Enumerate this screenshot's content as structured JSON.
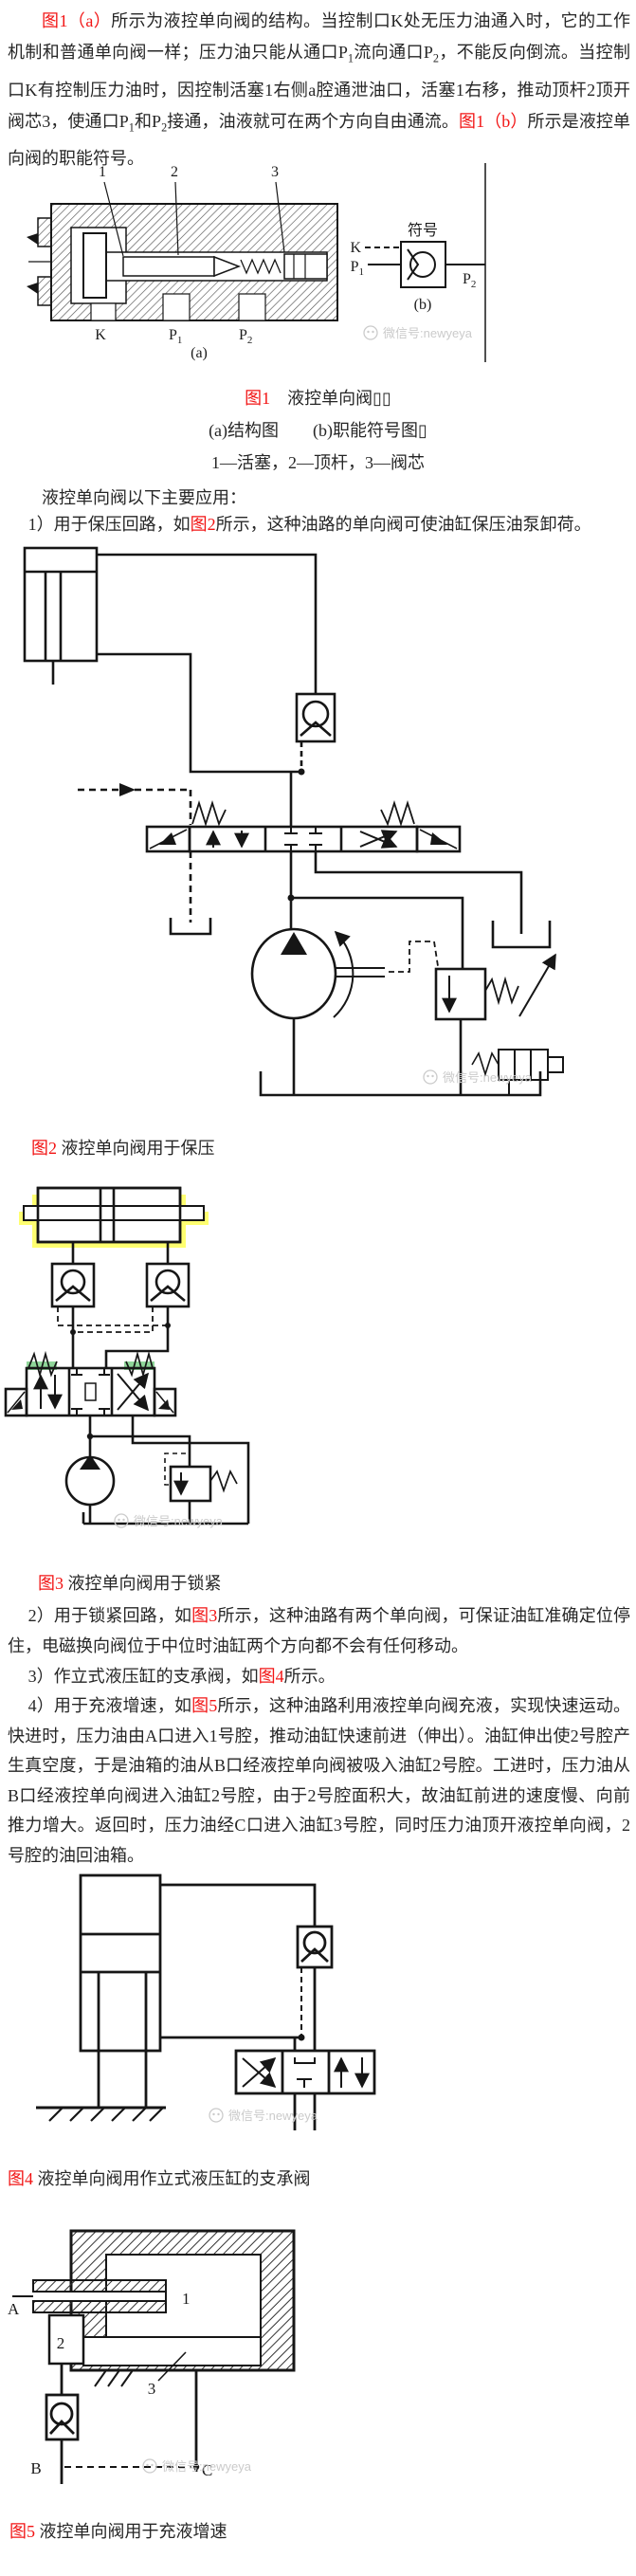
{
  "colors": {
    "red": "#f21414",
    "text": "#262626",
    "watermark": "#cbcbcb",
    "yellow": "#ffff70",
    "green": "#44bb55",
    "line": "#161616"
  },
  "watermark": "微信号:newyeya",
  "intro": {
    "segments": [
      {
        "t": "图1（a）",
        "c": "red"
      },
      {
        "t": "所示为液控单向阀的结构。当控制口K处无压力油通入时，它的工作机制和普通单向阀一样；压力油只能从通口P"
      },
      {
        "t": "1",
        "sub": true
      },
      {
        "t": "流向通口P"
      },
      {
        "t": "2",
        "sub": true
      },
      {
        "t": "，不能反向倒流。当控制口K有控制压力油时，因控制活塞1右侧a腔通泄油口，活塞1右移，推动顶杆2顶开阀芯3，使通口P"
      },
      {
        "t": "1",
        "sub": true
      },
      {
        "t": "和P"
      },
      {
        "t": "2",
        "sub": true
      },
      {
        "t": "接通，油液就可在两个方向自由通流。"
      },
      {
        "t": "图1（b）",
        "c": "red"
      },
      {
        "t": "所示是液控单向阀的职能符号。"
      }
    ]
  },
  "fig1": {
    "labels": {
      "n1": "1",
      "n2": "2",
      "n3": "3",
      "k": "K",
      "p": "P",
      "s1": "1",
      "s2": "2",
      "a": "(a)",
      "sym": "符号",
      "b": "(b)"
    }
  },
  "caption1": {
    "line1": {
      "segments": [
        {
          "t": "图1",
          "c": "red"
        },
        {
          "t": "　液控单向阀▯▯"
        }
      ]
    },
    "line2": {
      "segments": [
        {
          "t": "(a)结构图　　(b)职能符号图▯"
        }
      ]
    },
    "line3": {
      "segments": [
        {
          "t": "1—活塞，2—顶杆，3—阀芯"
        }
      ]
    }
  },
  "apps": {
    "segments": [
      {
        "t": "液控单向阀以下主要应用："
      }
    ]
  },
  "item1": {
    "segments": [
      {
        "t": "1）用于保压回路，如"
      },
      {
        "t": "图2",
        "c": "red"
      },
      {
        "t": "所示，这种油路的单向阀可使油缸保压油泵卸荷。"
      }
    ]
  },
  "caption2": {
    "segments": [
      {
        "t": "图2",
        "c": "red"
      },
      {
        "t": " 液控单向阀用于保压"
      }
    ]
  },
  "caption3": {
    "segments": [
      {
        "t": "图3",
        "c": "red"
      },
      {
        "t": " 液控单向阀用于锁紧"
      }
    ]
  },
  "item2": {
    "segments": [
      {
        "t": "2）用于锁紧回路，如"
      },
      {
        "t": "图3",
        "c": "red"
      },
      {
        "t": "所示，这种油路有两个单向阀，可保证油缸准确定位停住，电磁换向阀位于中位时油缸两个方向都不会有任何移动。"
      }
    ]
  },
  "item3": {
    "segments": [
      {
        "t": "3）作立式液压缸的支承阀，如"
      },
      {
        "t": "图4",
        "c": "red"
      },
      {
        "t": "所示。"
      }
    ]
  },
  "item4": {
    "segments": [
      {
        "t": "4）用于充液增速，如"
      },
      {
        "t": "图5",
        "c": "red"
      },
      {
        "t": "所示，这种油路利用液控单向阀充液，实现快速运动。快进时，压力油由A口进入1号腔，推动油缸快速前进（伸出）。油缸伸出使2号腔产生真空度，于是油箱的油从B口经液控单向阀被吸入油缸2号腔。工进时，压力油从B口经液控单向阀进入油缸2号腔，由于2号腔面积大，故油缸前进的速度慢、向前推力增大。返回时，压力油经C口进入油缸3号腔，同时压力油顶开液控单向阀，2号腔的油回油箱。"
      }
    ]
  },
  "caption4": {
    "segments": [
      {
        "t": "图4",
        "c": "red"
      },
      {
        "t": " 液控单向阀用作立式液压缸的支承阀"
      }
    ]
  },
  "fig5": {
    "labels": {
      "a": "A",
      "n1": "1",
      "n2": "2",
      "n3": "3",
      "b": "B",
      "c": "C"
    }
  },
  "caption5": {
    "segments": [
      {
        "t": "图5",
        "c": "red"
      },
      {
        "t": " 液控单向阀用于充液增速"
      }
    ]
  }
}
